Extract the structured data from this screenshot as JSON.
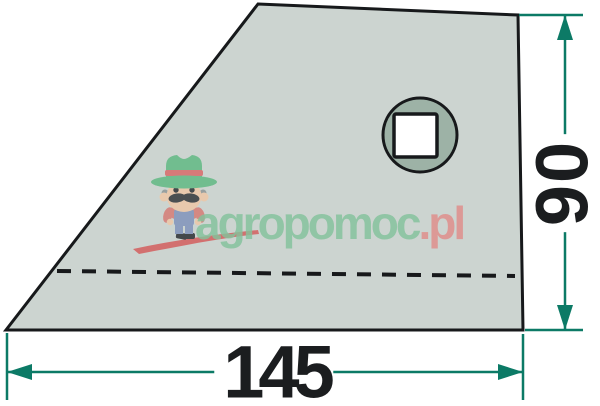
{
  "dimensions": {
    "width": {
      "value": "145"
    },
    "height": {
      "value": "90"
    }
  },
  "watermark": {
    "brand_primary": "agropomoc",
    "brand_suffix": ".pl",
    "mascot": "farmer-with-green-hat"
  },
  "colors": {
    "canvas": "#ffffff",
    "plate-fill": "#ccd4d0",
    "plate-stroke": "#17191b",
    "hole-fill": "#9db2a6",
    "dim": "#0c7a66",
    "text": "#1b1d1f",
    "brand-green": "#84c29c",
    "brand-red": "#e08d8a",
    "swoosh-red": "#d45f5f",
    "hat-green": "#62b984",
    "band-red": "#d96b6b",
    "skin": "#eec8a8",
    "shirt-red": "#d67d76",
    "overalls-blue": "#8294bb",
    "boot-black": "#2c3034",
    "hair-gray": "#8f9898",
    "eye-dark": "#2d3136"
  }
}
